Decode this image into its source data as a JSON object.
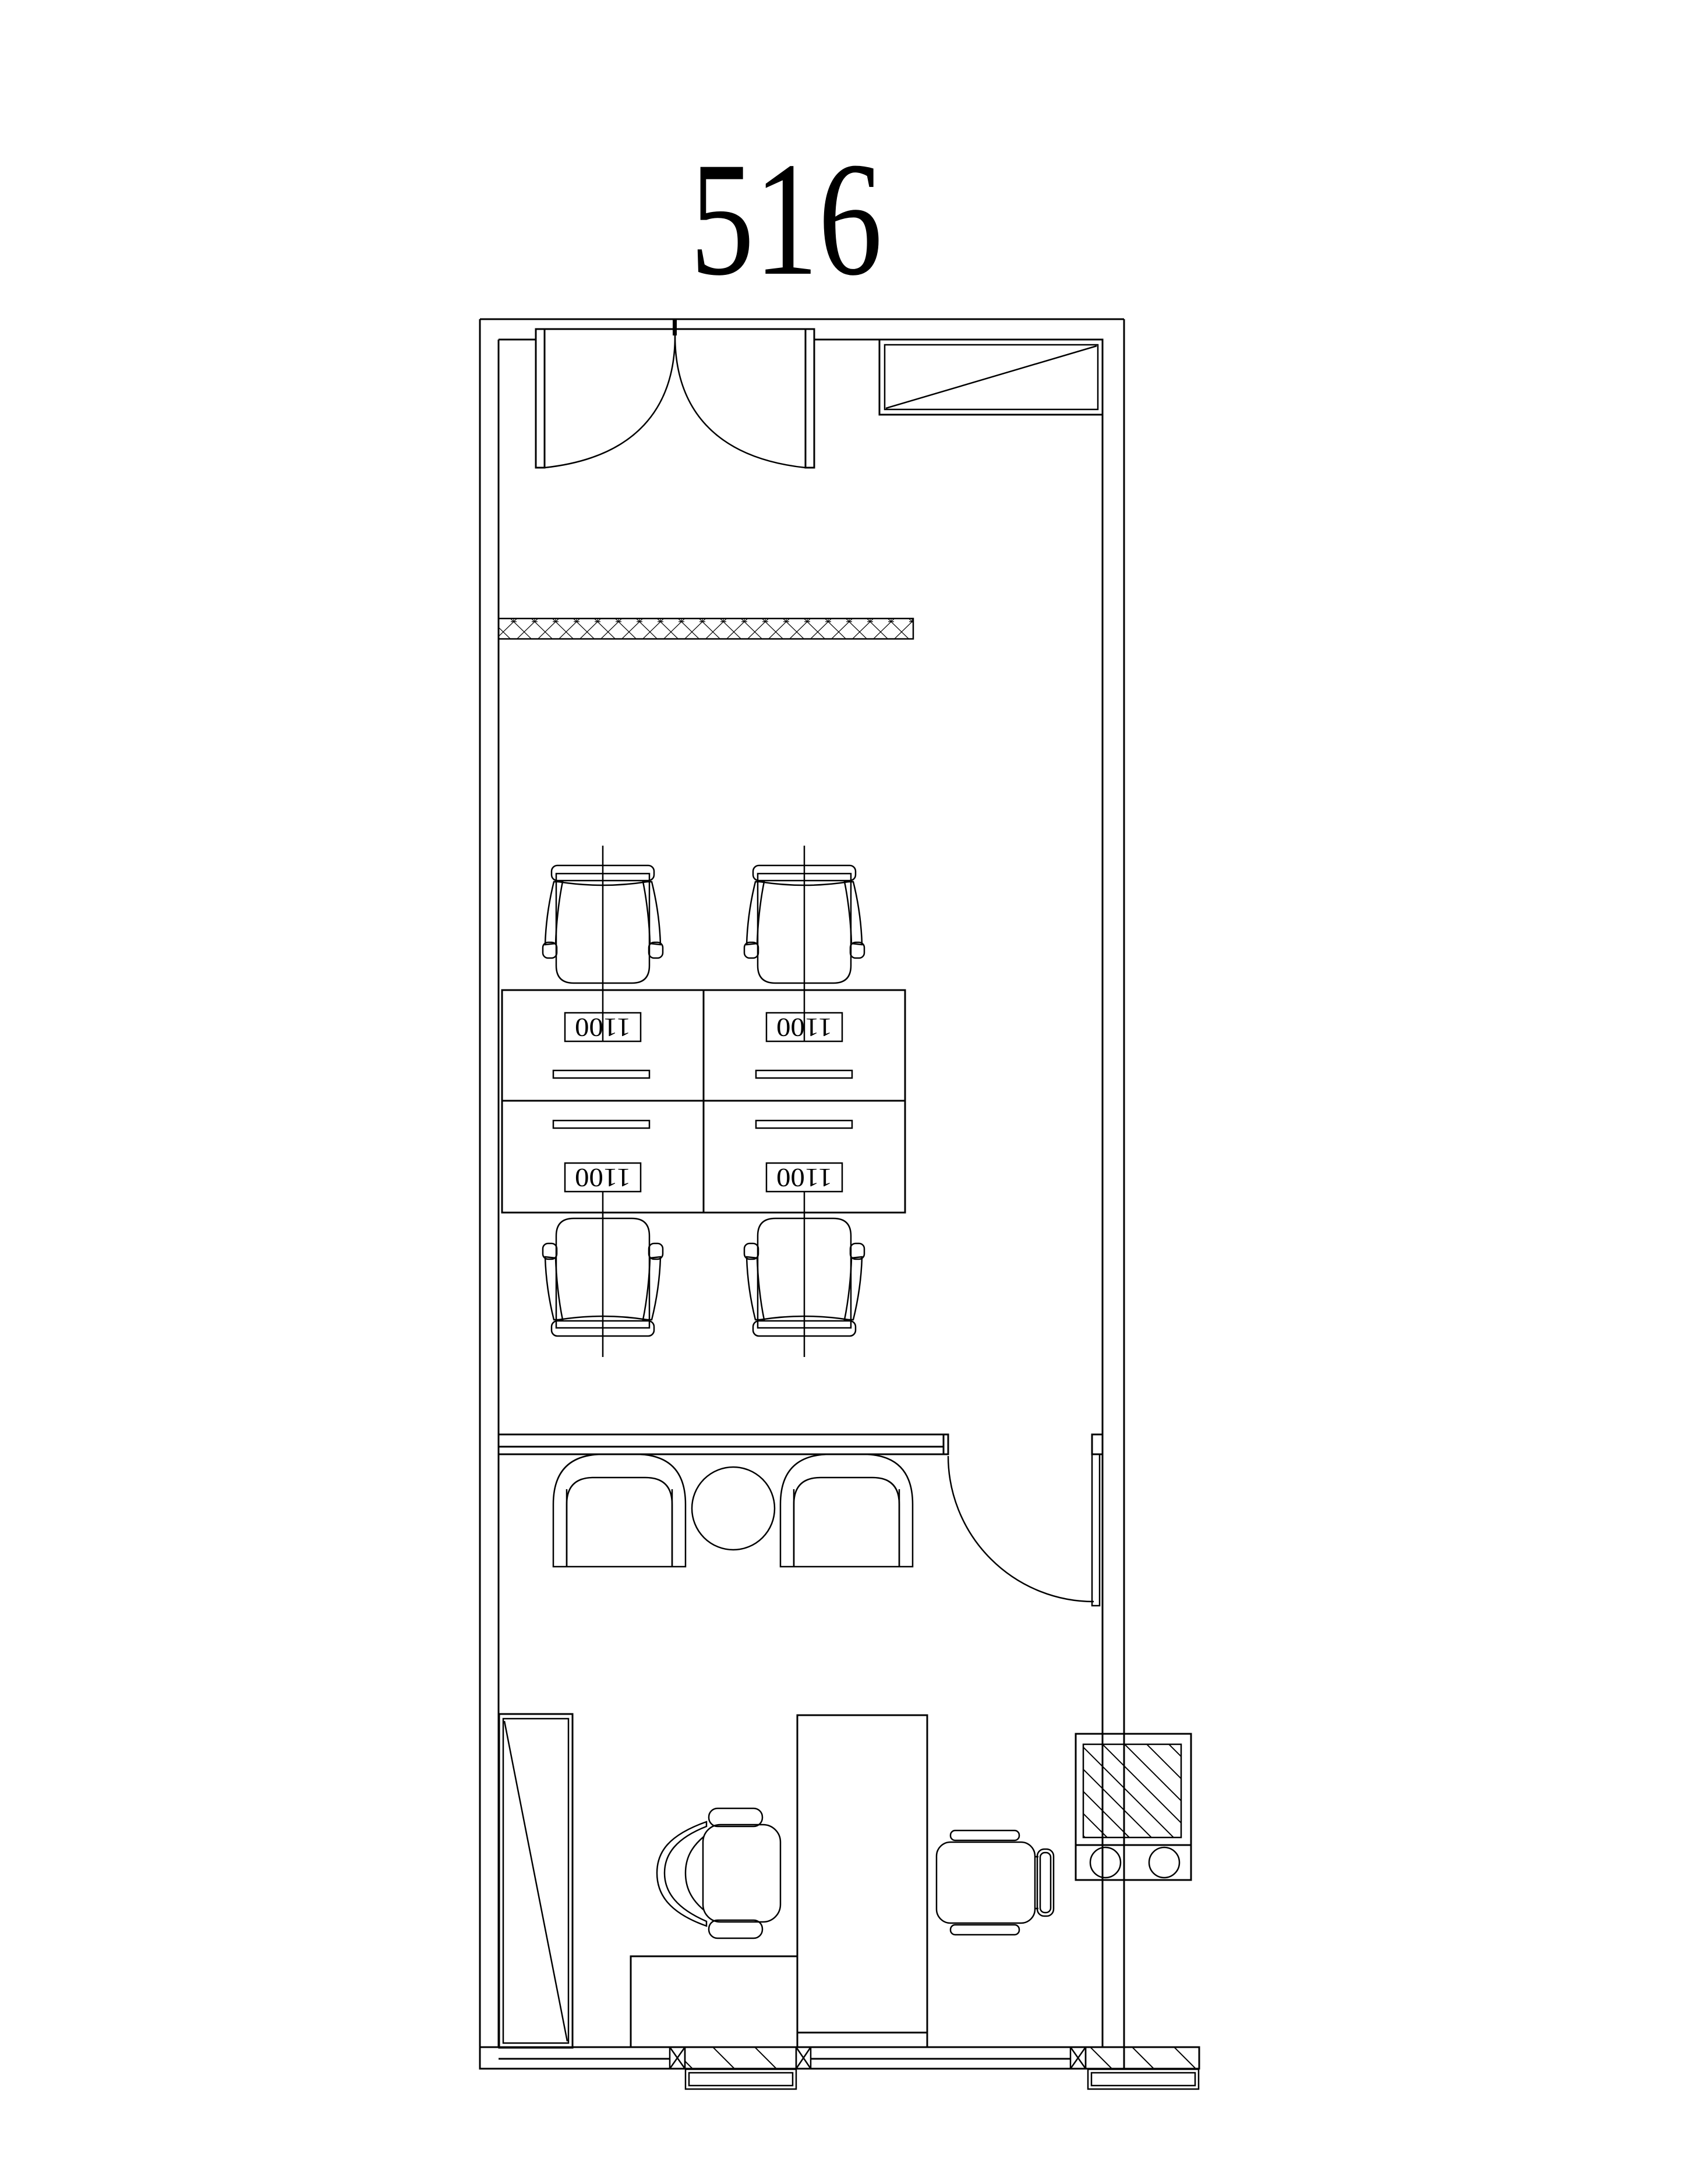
{
  "title": {
    "text": "516"
  },
  "workstations": {
    "labels": [
      "1100",
      "1100",
      "1100",
      "1100"
    ]
  },
  "colors": {
    "line": "#000000",
    "background": "#ffffff"
  },
  "icons": {
    "entry_double_door": "double-swing-door-icon",
    "partition_door": "single-swing-door-icon",
    "wall_cabinet": "crossed-shelf-icon",
    "storage_cabinet": "tall-cabinet-icon",
    "equipment_unit": "hatched-equipment-with-sinks-icon",
    "round_table": "round-table-icon"
  }
}
